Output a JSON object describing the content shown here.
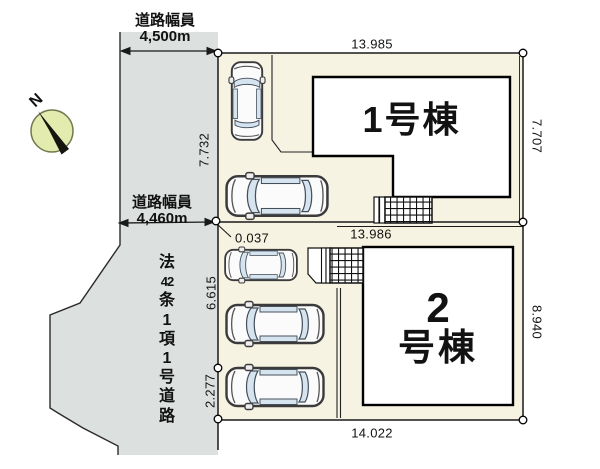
{
  "plan": {
    "compass": {
      "north_label": "N"
    },
    "road": {
      "width_top_title": "道路幅員",
      "width_top_value": "4,500m",
      "width_mid_title": "道路幅員",
      "width_mid_value": "4,460m",
      "type_segments": [
        "法",
        "42",
        "条",
        "1",
        "項",
        "1",
        "号",
        "道",
        "路"
      ]
    },
    "lot1": {
      "building_label": "1号棟",
      "dim_top": "13.985",
      "dim_right": "7.707",
      "dim_left": "7.732"
    },
    "lot2": {
      "building_label_line1": "2",
      "building_label_line2": "号棟",
      "dim_top": "13.986",
      "dim_offset": "0.037",
      "dim_left_upper": "6.615",
      "dim_left_lower": "2.277",
      "dim_right": "8.940",
      "dim_bottom": "14.022"
    },
    "colors": {
      "road_fill": "#dce1df",
      "lot_fill": "#f7f3e2",
      "building_fill": "#ffffff",
      "compass_fill": "#e3ebae",
      "line": "#1a1a1a"
    }
  }
}
